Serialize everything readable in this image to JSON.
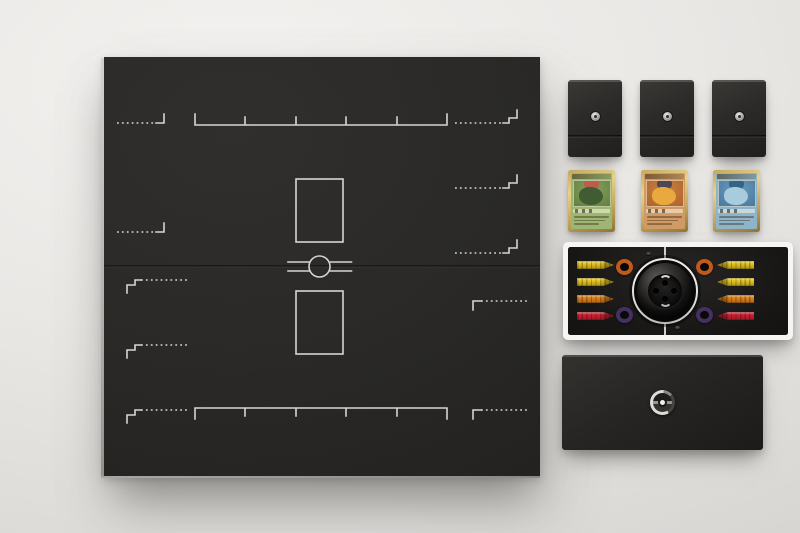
{
  "scene": {
    "label": "Pokemon trading card game set flat lay photo",
    "background": {
      "highlight": "#f3f2f0",
      "base": "#e7e5e2",
      "shadow": "#d2d0cd"
    }
  },
  "board": {
    "label": "folding game board",
    "surface_color": "#2b2a27",
    "marking_color": "#d7d5d1",
    "players": 2,
    "bench_slots_per_player": 5,
    "active_card_zones": 2,
    "center_emblem": "pokeball-divider"
  },
  "deck_boxes": [
    {
      "label": "deck box"
    },
    {
      "label": "deck box"
    },
    {
      "label": "deck box"
    }
  ],
  "deck_box_style": {
    "body": "#2b2a28",
    "emblem": "#c9c7c3"
  },
  "cards": [
    {
      "id": "grass",
      "label": "grass starter card",
      "border": "#c2a75d",
      "body": "#9fb573",
      "art_outer": "#86a159",
      "art_inner": "#5d7b41",
      "figure": "#3f5c33",
      "accent": "#c4574b"
    },
    {
      "id": "fire",
      "label": "fire starter card",
      "border": "#c9a85a",
      "body": "#d09a66",
      "art_outer": "#cd8342",
      "art_inner": "#a85e27",
      "figure": "#e8a93e",
      "accent": "#41415a"
    },
    {
      "id": "water",
      "label": "water starter card",
      "border": "#c2a75d",
      "body": "#8fb3c9",
      "art_outer": "#6b9cbd",
      "art_inner": "#447499",
      "figure": "#a8cbdd",
      "accent": "#2f5f82"
    }
  ],
  "tray": {
    "label": "accessory tray",
    "frame": "#f6f5f3",
    "bed": "#1a1918",
    "well_ring": "#eeedeb",
    "ball": "#161514",
    "counters_left": [
      "#e6c51f",
      "#e6c51f",
      "#e2831c",
      "#d12133"
    ],
    "counters_right": [
      "#e6c51f",
      "#e6c51f",
      "#e2831c",
      "#d12133"
    ],
    "rings": [
      {
        "pos": "top-left",
        "color": "#c05a1a"
      },
      {
        "pos": "top-right",
        "color": "#c05a1a"
      },
      {
        "pos": "bottom-left",
        "color": "#463063"
      },
      {
        "pos": "bottom-right",
        "color": "#463063"
      }
    ]
  },
  "bottom_box": {
    "label": "storage box",
    "body": "#242322",
    "logo_silver": "#d8d6d3"
  }
}
